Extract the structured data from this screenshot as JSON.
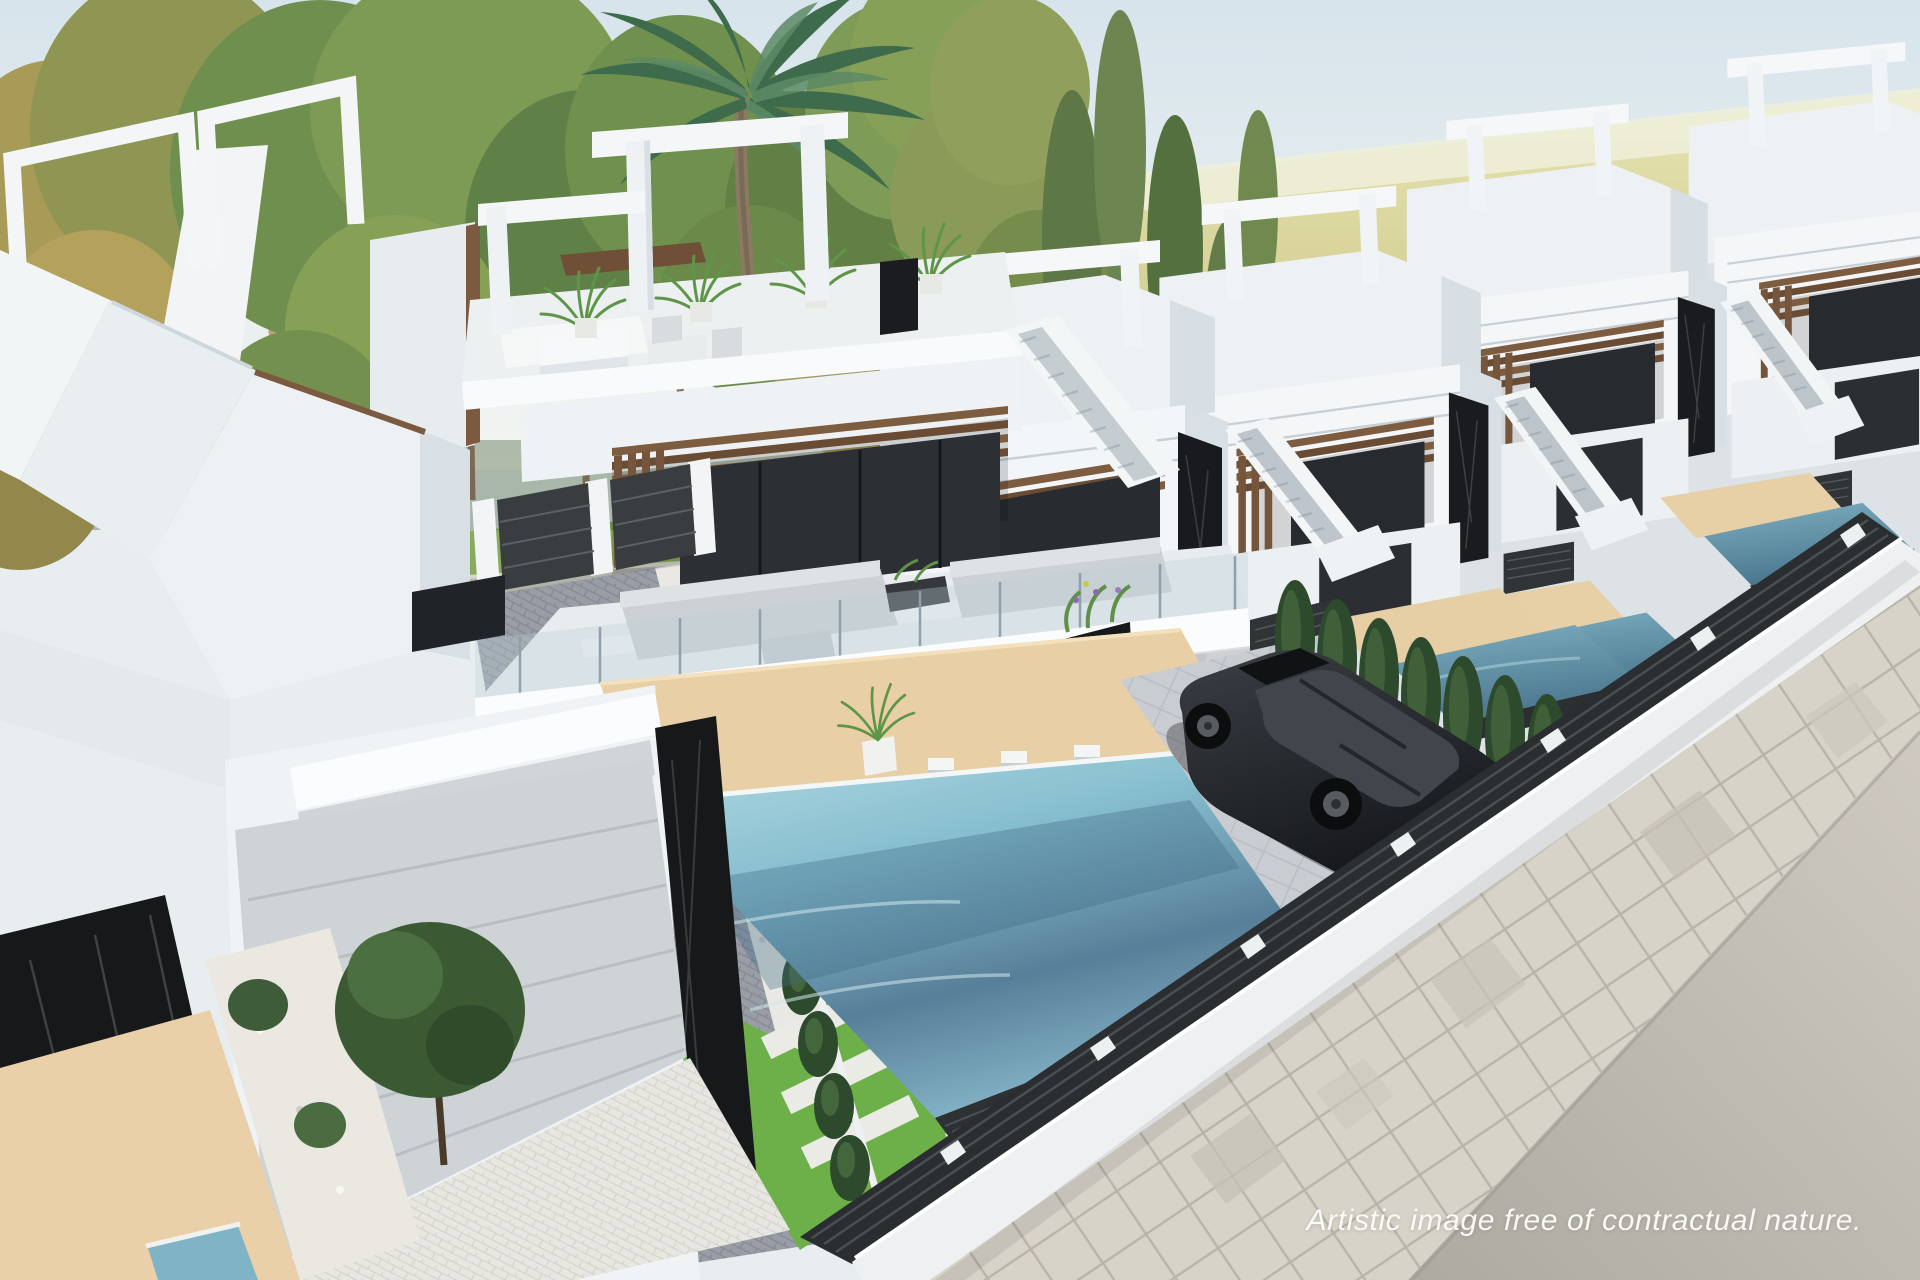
{
  "watermark": {
    "text": "Artistic image free of contractual nature."
  },
  "palette": {
    "sky": "#dce7ee",
    "field": "#c9c584",
    "foliage_green": "#6f8f4f",
    "foliage_autumn": "#ab9a57",
    "palm_green": "#3f6b4d",
    "villa_white": "#f4f6f8",
    "villa_shade": "#d9e1e7",
    "wood_slat": "#7a5a3e",
    "marble_black": "#17181a",
    "glass_dark": "#2b2f33",
    "pool_light": "#a8d4de",
    "pool_deep": "#527e97",
    "deck_tan": "#e8cfa5",
    "grass": "#6db049",
    "hedge": "#2e4a2c",
    "gravel": "#e9e8e2",
    "paver_light": "#e7e6e1",
    "paver_dark": "#989da6",
    "sidewalk": "#d8d3c9",
    "road": "#bdb8b0",
    "car_body": "#1c1f23",
    "fence_dark": "#2e3133",
    "watermark_text": "#fcfcfa"
  },
  "scene": {
    "type": "3D architectural aerial rendering",
    "objects": [
      "sky",
      "yellow field",
      "tree line",
      "palm tree",
      "row of modern white villas",
      "rooftop pergola frames",
      "wood slat canopies",
      "black marble pillars",
      "glass balustrades",
      "roof terraces with plants",
      "outdoor sofas",
      "swimming pools",
      "waterfall spouts",
      "tan pool decks",
      "artificial grass with stepping stones",
      "cypress hedges",
      "gravel beds",
      "herringbone paver driveway",
      "garage door",
      "entry gates",
      "dark slat fences",
      "parked black car",
      "stone tile sidewalk",
      "asphalt road"
    ]
  }
}
